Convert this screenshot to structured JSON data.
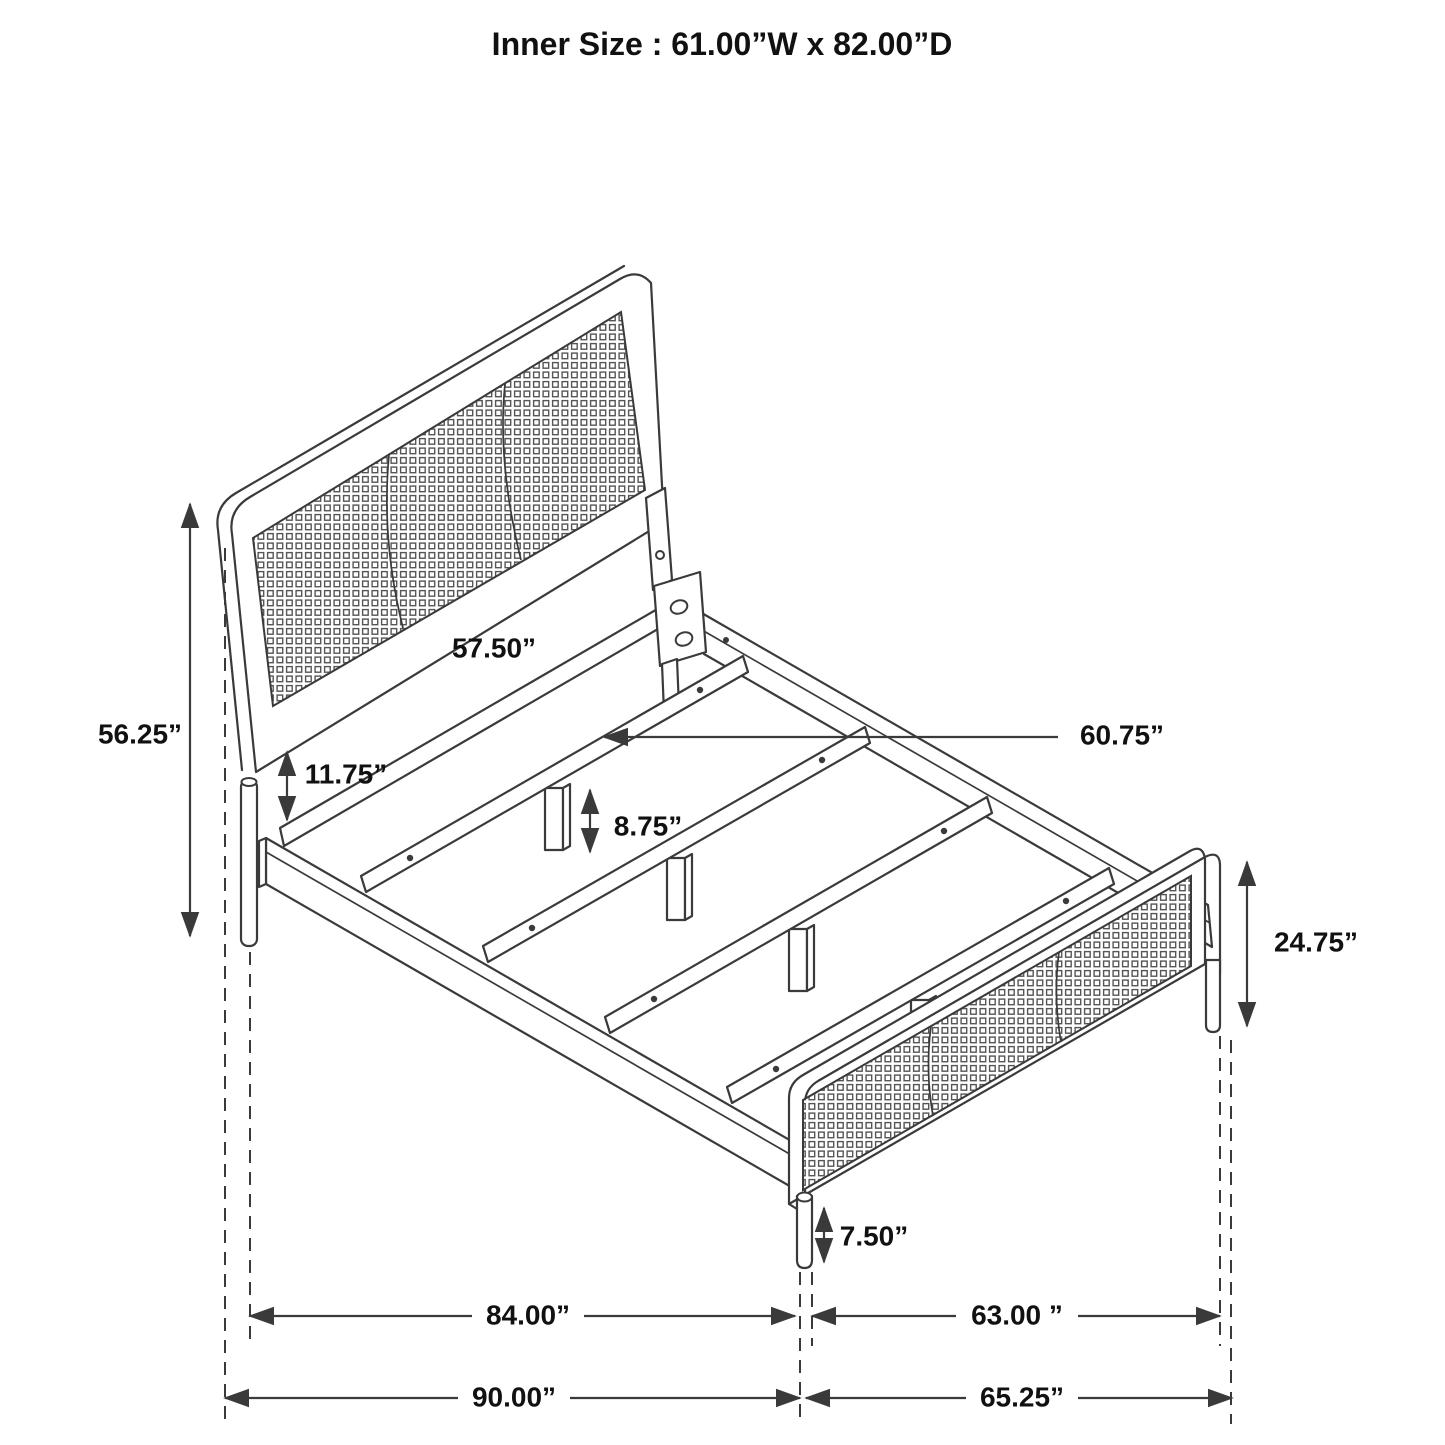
{
  "title": "Inner Size : 61.00”W x 82.00”D",
  "dimensions": {
    "headboard_height": "56.25”",
    "headboard_panel_width": "57.50”",
    "panel_to_rail_gap": "11.75”",
    "slat_leg_height": "8.75”",
    "slat_length": "60.75”",
    "footboard_height": "24.75”",
    "footboard_leg_height": "7.50”",
    "side_rail_span": "84.00”",
    "footboard_span": "63.00 ”",
    "overall_length": "90.00”",
    "overall_width": "65.25”"
  },
  "colors": {
    "line": "#3a3a3a",
    "text": "#111111",
    "background": "#ffffff"
  }
}
